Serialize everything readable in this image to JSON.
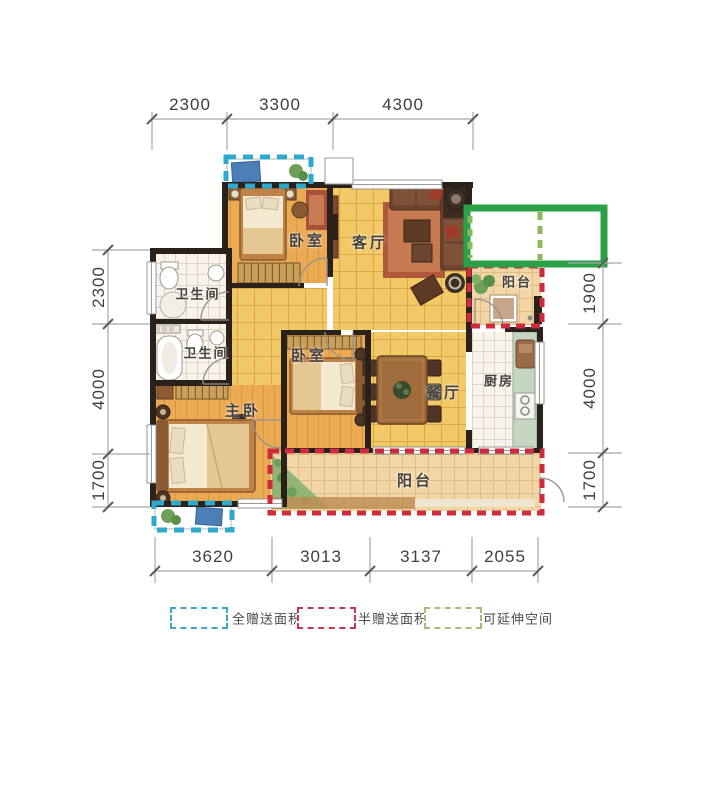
{
  "floorplan": {
    "room_labels": {
      "bedroom_top": "卧室",
      "living": "客厅",
      "bath_top": "卫生间",
      "bath_bottom": "卫生间",
      "master": "主卧",
      "bedroom_mid": "卧室",
      "dining": "餐厅",
      "kitchen": "厨房",
      "balcony_right": "阳台",
      "balcony_bottom": "阳台"
    },
    "dimensions": {
      "top": [
        "2300",
        "3300",
        "4300"
      ],
      "bottom": [
        "3620",
        "3013",
        "3137",
        "2055"
      ],
      "left": [
        "2300",
        "4000",
        "1700"
      ],
      "right": [
        "1900",
        "4000",
        "1700"
      ]
    },
    "colors": {
      "wall": "#2b211b",
      "full_gift_dash": "#2fa8cf",
      "half_gift_dash": "#ce2b3e",
      "extendable_solid": "#2ba147",
      "extendable_dash": "#8db95e"
    }
  },
  "legend": {
    "items": [
      {
        "label": "全赠送面积",
        "color": "#3fa6c6"
      },
      {
        "label": "半赠送面积",
        "color": "#c43a50"
      },
      {
        "label": "可延伸空间",
        "color": "#a3bf77"
      }
    ]
  }
}
